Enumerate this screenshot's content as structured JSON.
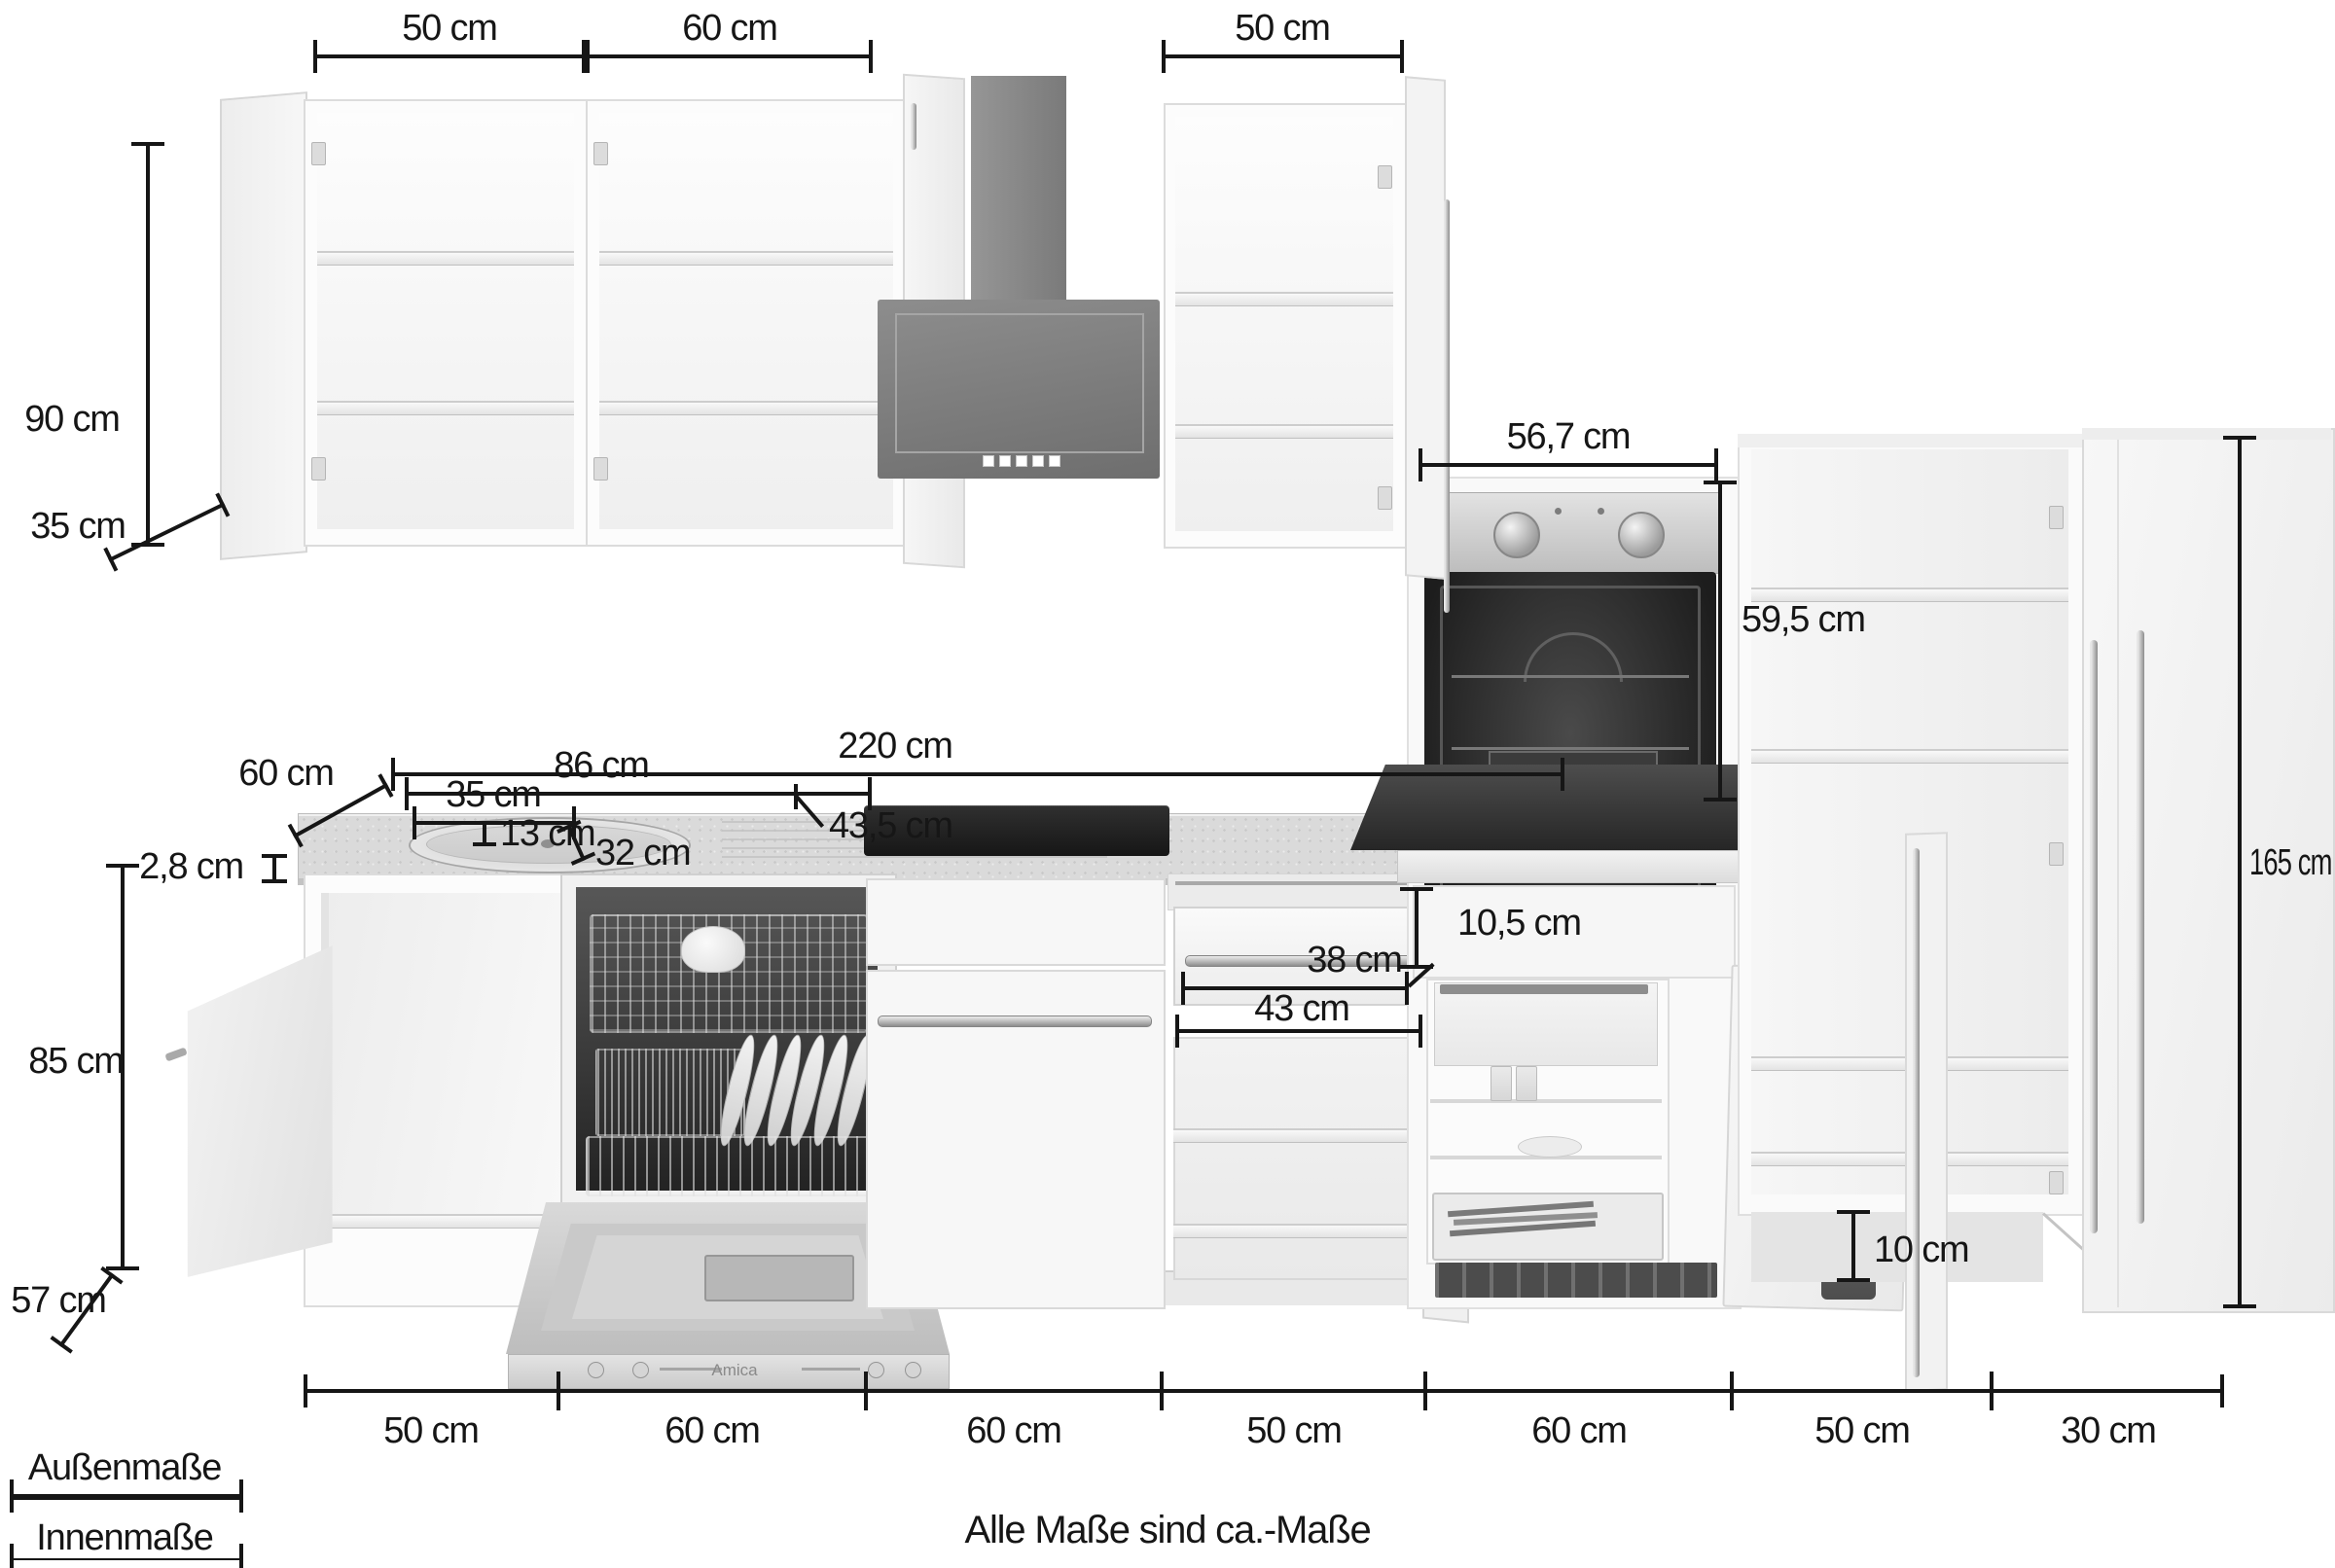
{
  "footnote": "Alle Maße sind ca.-Maße",
  "legend": {
    "outer_label": "Außenmaße",
    "inner_label": "Innenmaße"
  },
  "brand": {
    "dishwasher": "Amica"
  },
  "colors": {
    "dim_line": "#161616",
    "hood_gray": "#7e7e7e",
    "oven_cavity": "#262626",
    "stainless": "#c8c8c8",
    "cabinet_white": "#f8f8f8",
    "worktop_gray": "#d9d9d9"
  },
  "dims": {
    "top_left_width": "50 cm",
    "top_mid_width": "60 cm",
    "top_right_width": "50 cm",
    "wall_cab_height": "90 cm",
    "wall_cab_depth": "35 cm",
    "worktop_run": "220 cm",
    "worktop_depth": "60 cm",
    "worktop_thickness": "2,8 cm",
    "sink_unit_width": "86 cm",
    "sink_bowl_width": "35 cm",
    "sink_bowl_depth": "13 cm",
    "sink_bowl_length": "32 cm",
    "sink_total_depth": "43,5 cm",
    "base_height": "85 cm",
    "base_depth": "57 cm",
    "oven_niche_width": "56,7 cm",
    "oven_niche_height": "59,5 cm",
    "drawer_inner_width": "38 cm",
    "drawer_outer_width": "43 cm",
    "drawer_front_height": "10,5 cm",
    "tall_height": "165 cm",
    "plinth_height": "10 cm",
    "bottom_segments": [
      "50 cm",
      "60 cm",
      "60 cm",
      "50 cm",
      "60 cm",
      "50 cm",
      "30 cm"
    ]
  }
}
